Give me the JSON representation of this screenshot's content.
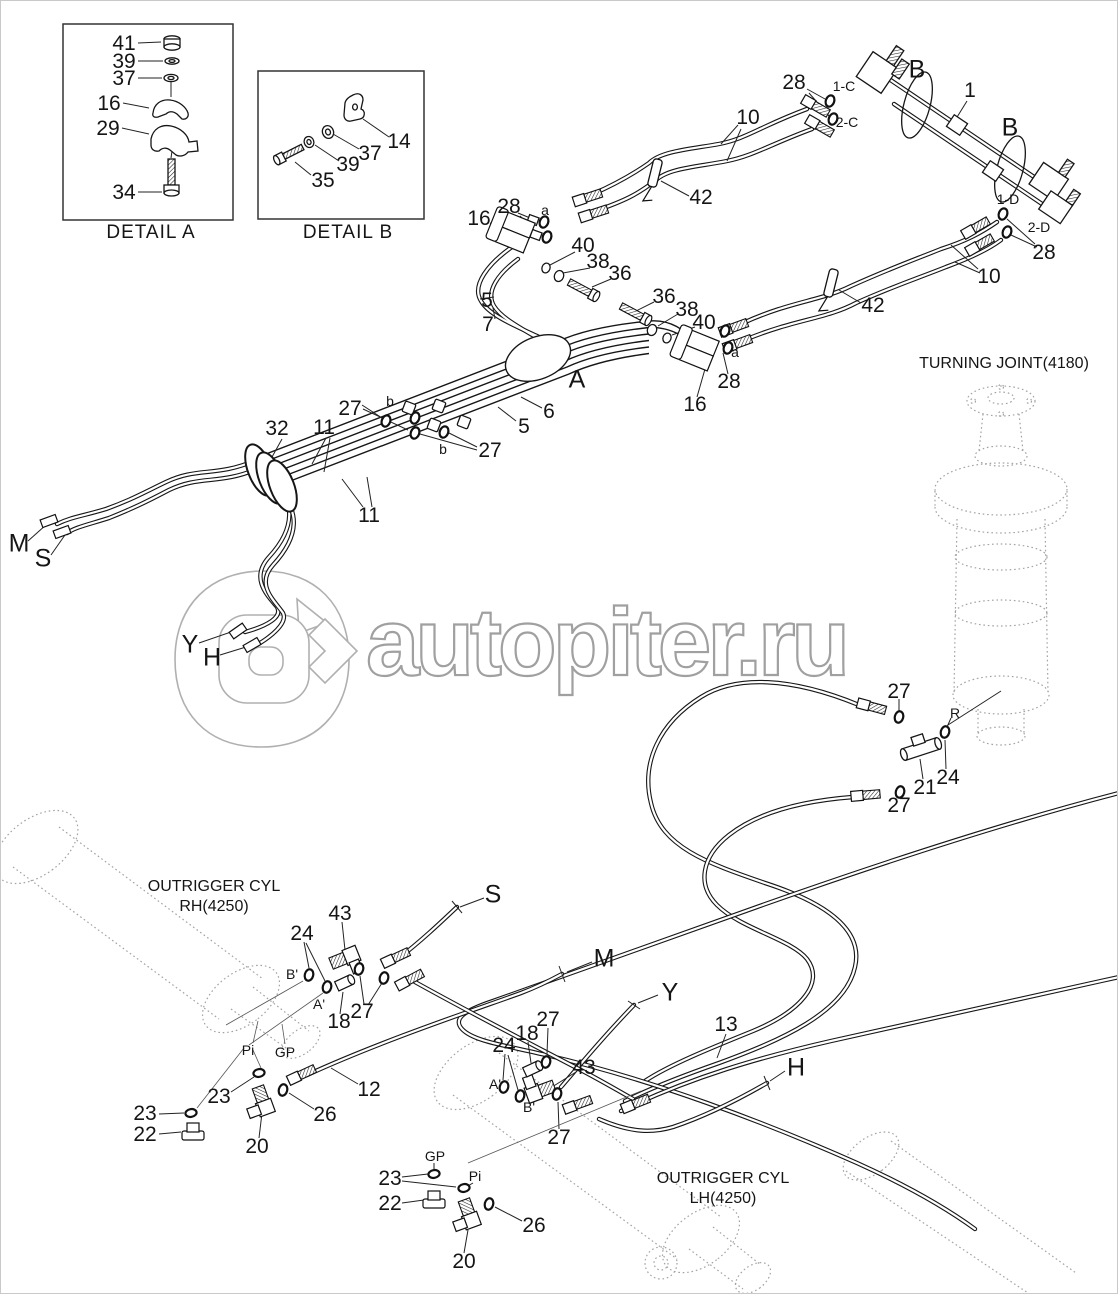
{
  "watermark": {
    "text": "autopiter.ru",
    "logo_icon": "autopiter-a-arrow-logo",
    "outline_color": "#a0a0a0"
  },
  "colors": {
    "line": "#161616",
    "ghost": "#a3a3a3",
    "background": "#ffffff"
  },
  "captions": {
    "detail_a": "DETAIL A",
    "detail_b": "DETAIL B",
    "turning_joint": "TURNING JOINT(4180)",
    "outrigger_rh_1": "OUTRIGGER CYL",
    "outrigger_rh_2": "RH(4250)",
    "outrigger_lh_1": "OUTRIGGER CYL",
    "outrigger_lh_2": "LH(4250)"
  },
  "callouts": [
    {
      "label": "41",
      "x": 123,
      "y": 43,
      "kind": "num"
    },
    {
      "label": "39",
      "x": 123,
      "y": 61,
      "kind": "num"
    },
    {
      "label": "37",
      "x": 123,
      "y": 78,
      "kind": "num"
    },
    {
      "label": "16",
      "x": 108,
      "y": 103,
      "kind": "num"
    },
    {
      "label": "29",
      "x": 107,
      "y": 128,
      "kind": "num"
    },
    {
      "label": "34",
      "x": 123,
      "y": 192,
      "kind": "num"
    },
    {
      "label": "DETAIL A",
      "x": 150,
      "y": 232,
      "kind": "detail"
    },
    {
      "label": "14",
      "x": 398,
      "y": 141,
      "kind": "num"
    },
    {
      "label": "37",
      "x": 369,
      "y": 153,
      "kind": "num"
    },
    {
      "label": "39",
      "x": 347,
      "y": 164,
      "kind": "num"
    },
    {
      "label": "35",
      "x": 322,
      "y": 180,
      "kind": "num"
    },
    {
      "label": "DETAIL B",
      "x": 347,
      "y": 232,
      "kind": "detail"
    },
    {
      "label": "28",
      "x": 793,
      "y": 82,
      "kind": "num"
    },
    {
      "label": "1-C",
      "x": 843,
      "y": 85,
      "kind": "port"
    },
    {
      "label": "B",
      "x": 916,
      "y": 69,
      "kind": "letter"
    },
    {
      "label": "1",
      "x": 969,
      "y": 90,
      "kind": "num"
    },
    {
      "label": "2-C",
      "x": 846,
      "y": 121,
      "kind": "port"
    },
    {
      "label": "B",
      "x": 1009,
      "y": 127,
      "kind": "letter"
    },
    {
      "label": "10",
      "x": 747,
      "y": 117,
      "kind": "num"
    },
    {
      "label": "1-D",
      "x": 1007,
      "y": 198,
      "kind": "port"
    },
    {
      "label": "2-D",
      "x": 1038,
      "y": 226,
      "kind": "port"
    },
    {
      "label": "28",
      "x": 1043,
      "y": 252,
      "kind": "num"
    },
    {
      "label": "42",
      "x": 700,
      "y": 197,
      "kind": "num"
    },
    {
      "label": "16",
      "x": 478,
      "y": 218,
      "kind": "num"
    },
    {
      "label": "28",
      "x": 508,
      "y": 206,
      "kind": "num"
    },
    {
      "label": "a",
      "x": 544,
      "y": 209,
      "kind": "port"
    },
    {
      "label": "40",
      "x": 582,
      "y": 245,
      "kind": "num"
    },
    {
      "label": "38",
      "x": 597,
      "y": 261,
      "kind": "num"
    },
    {
      "label": "36",
      "x": 619,
      "y": 273,
      "kind": "num"
    },
    {
      "label": "5",
      "x": 486,
      "y": 300,
      "kind": "num"
    },
    {
      "label": "7",
      "x": 487,
      "y": 324,
      "kind": "num"
    },
    {
      "label": "36",
      "x": 663,
      "y": 296,
      "kind": "num"
    },
    {
      "label": "38",
      "x": 686,
      "y": 309,
      "kind": "num"
    },
    {
      "label": "40",
      "x": 703,
      "y": 322,
      "kind": "num"
    },
    {
      "label": "a",
      "x": 734,
      "y": 351,
      "kind": "port"
    },
    {
      "label": "28",
      "x": 728,
      "y": 381,
      "kind": "num"
    },
    {
      "label": "16",
      "x": 694,
      "y": 404,
      "kind": "num"
    },
    {
      "label": "42",
      "x": 872,
      "y": 305,
      "kind": "num"
    },
    {
      "label": "10",
      "x": 988,
      "y": 276,
      "kind": "num"
    },
    {
      "label": "A",
      "x": 576,
      "y": 379,
      "kind": "letter"
    },
    {
      "label": "32",
      "x": 276,
      "y": 428,
      "kind": "num"
    },
    {
      "label": "11",
      "x": 323,
      "y": 427,
      "kind": "num"
    },
    {
      "label": "27",
      "x": 349,
      "y": 408,
      "kind": "num"
    },
    {
      "label": "b",
      "x": 389,
      "y": 400,
      "kind": "port"
    },
    {
      "label": "b",
      "x": 442,
      "y": 448,
      "kind": "port"
    },
    {
      "label": "27",
      "x": 489,
      "y": 450,
      "kind": "num"
    },
    {
      "label": "5",
      "x": 523,
      "y": 426,
      "kind": "num"
    },
    {
      "label": "6",
      "x": 548,
      "y": 411,
      "kind": "num"
    },
    {
      "label": "11",
      "x": 368,
      "y": 515,
      "kind": "num"
    },
    {
      "label": "M",
      "x": 18,
      "y": 543,
      "kind": "letter"
    },
    {
      "label": "S",
      "x": 42,
      "y": 558,
      "kind": "letter"
    },
    {
      "label": "Y",
      "x": 189,
      "y": 644,
      "kind": "letter"
    },
    {
      "label": "H",
      "x": 211,
      "y": 657,
      "kind": "letter"
    },
    {
      "label": "TURNING JOINT(4180)",
      "x": 1003,
      "y": 363,
      "kind": "caption"
    },
    {
      "label": "27",
      "x": 898,
      "y": 691,
      "kind": "num"
    },
    {
      "label": "R",
      "x": 954,
      "y": 712,
      "kind": "port"
    },
    {
      "label": "21",
      "x": 924,
      "y": 787,
      "kind": "num"
    },
    {
      "label": "24",
      "x": 947,
      "y": 777,
      "kind": "num"
    },
    {
      "label": "27",
      "x": 898,
      "y": 805,
      "kind": "num"
    },
    {
      "label": "OUTRIGGER CYL",
      "x": 213,
      "y": 886,
      "kind": "caption"
    },
    {
      "label": "RH(4250)",
      "x": 213,
      "y": 906,
      "kind": "caption"
    },
    {
      "label": "43",
      "x": 339,
      "y": 913,
      "kind": "num"
    },
    {
      "label": "24",
      "x": 301,
      "y": 933,
      "kind": "num"
    },
    {
      "label": "B'",
      "x": 291,
      "y": 973,
      "kind": "port"
    },
    {
      "label": "A'",
      "x": 318,
      "y": 1003,
      "kind": "port"
    },
    {
      "label": "18",
      "x": 338,
      "y": 1021,
      "kind": "num"
    },
    {
      "label": "27",
      "x": 361,
      "y": 1011,
      "kind": "num"
    },
    {
      "label": "S",
      "x": 492,
      "y": 894,
      "kind": "letter"
    },
    {
      "label": "M",
      "x": 603,
      "y": 958,
      "kind": "letter"
    },
    {
      "label": "Y",
      "x": 669,
      "y": 992,
      "kind": "letter"
    },
    {
      "label": "13",
      "x": 725,
      "y": 1024,
      "kind": "num"
    },
    {
      "label": "H",
      "x": 795,
      "y": 1067,
      "kind": "letter"
    },
    {
      "label": "24",
      "x": 503,
      "y": 1045,
      "kind": "num"
    },
    {
      "label": "18",
      "x": 526,
      "y": 1033,
      "kind": "num"
    },
    {
      "label": "27",
      "x": 547,
      "y": 1019,
      "kind": "num"
    },
    {
      "label": "43",
      "x": 583,
      "y": 1067,
      "kind": "num"
    },
    {
      "label": "A'",
      "x": 494,
      "y": 1083,
      "kind": "port"
    },
    {
      "label": "B'",
      "x": 528,
      "y": 1106,
      "kind": "port"
    },
    {
      "label": "27",
      "x": 558,
      "y": 1137,
      "kind": "num"
    },
    {
      "label": "Pi",
      "x": 247,
      "y": 1049,
      "kind": "port"
    },
    {
      "label": "GP",
      "x": 284,
      "y": 1051,
      "kind": "port"
    },
    {
      "label": "23",
      "x": 144,
      "y": 1113,
      "kind": "num"
    },
    {
      "label": "22",
      "x": 144,
      "y": 1134,
      "kind": "num"
    },
    {
      "label": "23",
      "x": 218,
      "y": 1096,
      "kind": "num"
    },
    {
      "label": "20",
      "x": 256,
      "y": 1146,
      "kind": "num"
    },
    {
      "label": "26",
      "x": 324,
      "y": 1114,
      "kind": "num"
    },
    {
      "label": "12",
      "x": 368,
      "y": 1089,
      "kind": "num"
    },
    {
      "label": "GP",
      "x": 434,
      "y": 1155,
      "kind": "port"
    },
    {
      "label": "Pi",
      "x": 474,
      "y": 1175,
      "kind": "port"
    },
    {
      "label": "23",
      "x": 389,
      "y": 1178,
      "kind": "num"
    },
    {
      "label": "22",
      "x": 389,
      "y": 1203,
      "kind": "num"
    },
    {
      "label": "26",
      "x": 533,
      "y": 1225,
      "kind": "num"
    },
    {
      "label": "20",
      "x": 463,
      "y": 1261,
      "kind": "num"
    },
    {
      "label": "OUTRIGGER CYL",
      "x": 722,
      "y": 1178,
      "kind": "caption"
    },
    {
      "label": "LH(4250)",
      "x": 722,
      "y": 1198,
      "kind": "caption"
    }
  ]
}
